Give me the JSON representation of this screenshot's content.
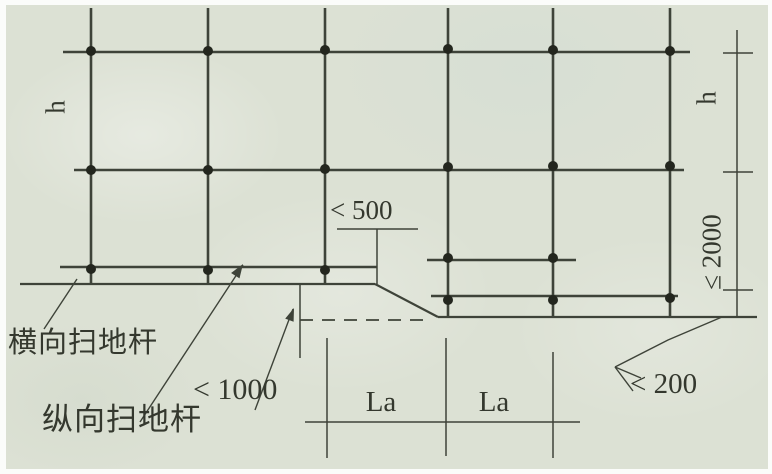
{
  "figure": {
    "labels": {
      "height_left": "h",
      "height_right": "h",
      "spacing_max": "≤ 2000",
      "edge_offset_max": "< 500",
      "step_height_max": "< 1000",
      "transverse_sweeper": "横向扫地杆",
      "longitudinal_sweeper": "纵向扫地杆",
      "span_la_1": "La",
      "span_la_2": "La",
      "base_offset_max": "< 200"
    },
    "colors": {
      "paper": "#dce1d4",
      "ink": "#3e4339",
      "dot": "#23261e",
      "text": "#34382e"
    }
  }
}
